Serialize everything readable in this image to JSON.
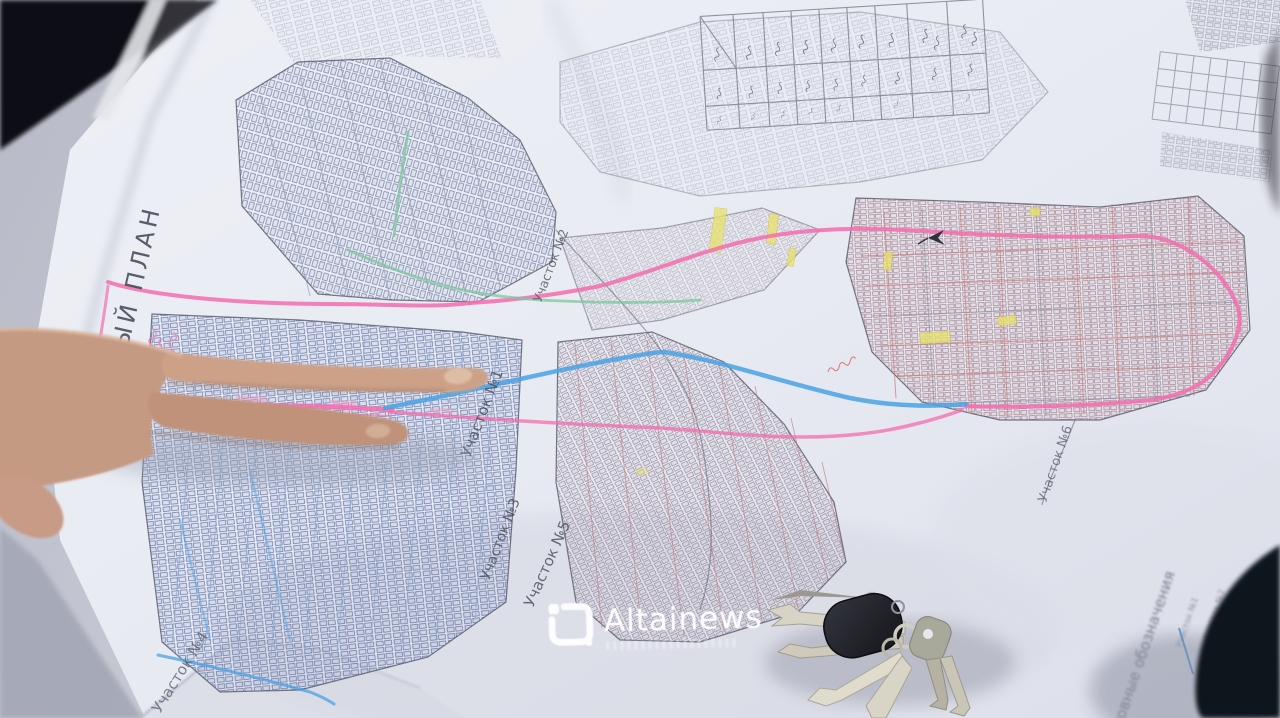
{
  "watermark": {
    "brand": "Altainews",
    "logo_icon": "altainews-logo"
  },
  "map": {
    "title_rotated_partial": "ННЫЙ ПЛАН",
    "sections": [
      {
        "label": "Участок №1"
      },
      {
        "label": "Участок №2"
      },
      {
        "label": "Участок №3"
      },
      {
        "label": "Участок №4"
      },
      {
        "label": "Участок №5"
      },
      {
        "label": "Участок №6"
      }
    ],
    "legend_heading_rotated": "условные обозначения",
    "corner_section_labels": [
      "Участок №1",
      "Участок №2",
      "Участок №3"
    ],
    "route_colors": {
      "highlight_pink": "#f46cae",
      "highlight_blue": "#49a2e4",
      "highlight_green": "#7cc79c",
      "street_red": "#cd7878",
      "street_blue": "#86a8d2"
    }
  },
  "objects": {
    "hand_icon": "pointing-hand",
    "keys_icon": "key-bunch",
    "north_icon": "north-arrow-icon",
    "table_icon": "data-table-sketch"
  }
}
